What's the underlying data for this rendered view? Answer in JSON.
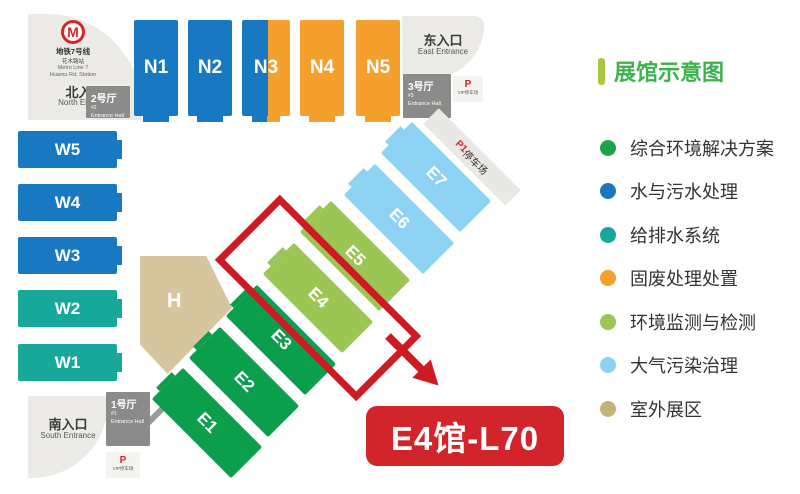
{
  "map": {
    "metro": {
      "logo_glyph": "M",
      "zh": "地铁7号线",
      "station_zh": "花木路站",
      "en": "Metro Line 7",
      "station_en": "Huamu Rd. Station"
    },
    "entrances": {
      "north": {
        "zh": "北入口",
        "en": "North Entrance"
      },
      "east": {
        "zh": "东入口",
        "en": "East Entrance"
      },
      "south": {
        "zh": "南入口",
        "en": "South Entrance"
      }
    },
    "entrance_halls": {
      "h1": {
        "name": "1号厅",
        "num": "#1",
        "sub": "Entrance Hall"
      },
      "h2": {
        "name": "2号厅",
        "num": "#2",
        "sub": "Entrance Hall"
      },
      "h3": {
        "name": "3号厅",
        "num": "#3",
        "sub": "Entrance Hall"
      }
    },
    "parking": {
      "vip_p": "P",
      "vip_label": "VIP停车场",
      "p1": "P1",
      "p1_label": "停车场"
    },
    "halls": {
      "n1": "N1",
      "n2": "N2",
      "n3": "N3",
      "n4": "N4",
      "n5": "N5",
      "w1": "W1",
      "w2": "W2",
      "w3": "W3",
      "w4": "W4",
      "w5": "W5",
      "e1": "E1",
      "e2": "E2",
      "e3": "E3",
      "e4": "E4",
      "e5": "E5",
      "e6": "E6",
      "e7": "E7",
      "h": "H"
    },
    "highlight_label": "E4馆-L70"
  },
  "legend": {
    "title": "展馆示意图",
    "title_color": "#3bb34a",
    "title_bar_color": "#a8c83d",
    "items": [
      {
        "label": "综合环境解决方案",
        "color": "#1fa24a"
      },
      {
        "label": "水与污水处理",
        "color": "#1878c2"
      },
      {
        "label": "给排水系统",
        "color": "#17a79b"
      },
      {
        "label": "固废处理处置",
        "color": "#f5a02c"
      },
      {
        "label": "环境监测与检测",
        "color": "#9cc653"
      },
      {
        "label": "大气污染治理",
        "color": "#8ed2f3"
      },
      {
        "label": "室外展区",
        "color": "#c3b377"
      }
    ]
  },
  "colors": {
    "hall_blue": "#1878c2",
    "hall_orange": "#f5a02c",
    "hall_teal": "#17a79b",
    "hall_green": "#0b9f4d",
    "hall_light_green": "#9cc653",
    "hall_light_blue": "#8ed2f3",
    "outdoor_tan": "#d6c69e",
    "highlight_red": "#ce1a23",
    "label_red": "#d2242b",
    "entrance_hall_gray": "#8b8b89",
    "plaza_gray": "#eceae7",
    "metro_red": "#d5252b"
  }
}
